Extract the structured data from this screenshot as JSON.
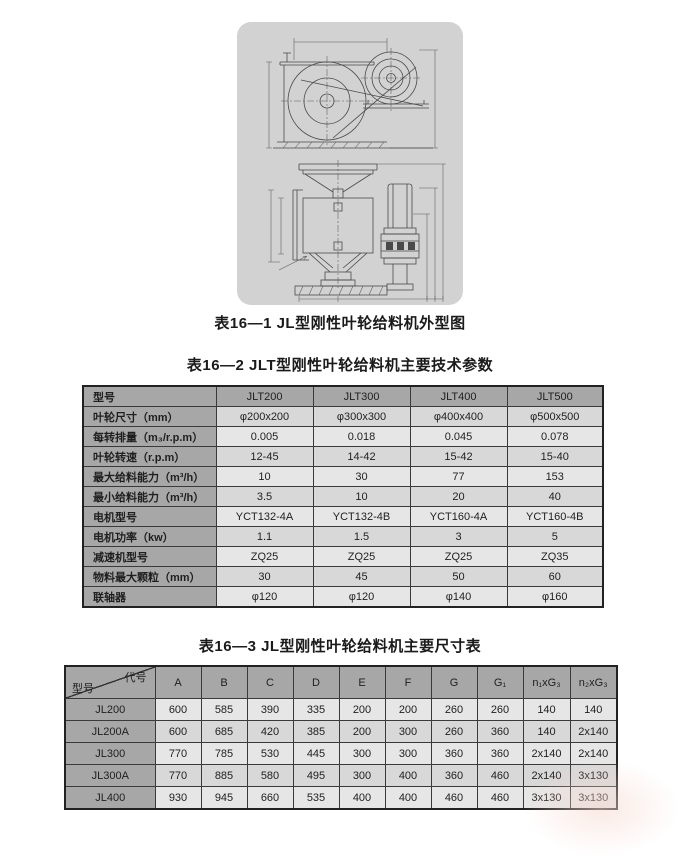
{
  "figure": {
    "caption": "表16—1 JL型刚性叶轮给料机外型图"
  },
  "table2": {
    "caption": "表16—2 JLT型刚性叶轮给料机主要技术参数",
    "rows": [
      {
        "label": "型号",
        "header": true,
        "values": [
          "JLT200",
          "JLT300",
          "JLT400",
          "JLT500"
        ]
      },
      {
        "label": "叶轮尺寸（mm）",
        "values": [
          "φ200x200",
          "φ300x300",
          "φ400x400",
          "φ500x500"
        ]
      },
      {
        "label": "每转排量（m₃/r.p.m）",
        "values": [
          "0.005",
          "0.018",
          "0.045",
          "0.078"
        ]
      },
      {
        "label": "叶轮转速（r.p.m）",
        "values": [
          "12-45",
          "14-42",
          "15-42",
          "15-40"
        ]
      },
      {
        "label": "最大给料能力（m³/h）",
        "values": [
          "10",
          "30",
          "77",
          "153"
        ]
      },
      {
        "label": "最小给料能力（m³/h）",
        "values": [
          "3.5",
          "10",
          "20",
          "40"
        ]
      },
      {
        "label": "电机型号",
        "values": [
          "YCT132-4A",
          "YCT132-4B",
          "YCT160-4A",
          "YCT160-4B"
        ]
      },
      {
        "label": "电机功率（kw）",
        "values": [
          "1.1",
          "1.5",
          "3",
          "5"
        ]
      },
      {
        "label": "减速机型号",
        "values": [
          "ZQ25",
          "ZQ25",
          "ZQ25",
          "ZQ35"
        ]
      },
      {
        "label": "物料最大颗粒（mm）",
        "values": [
          "30",
          "45",
          "50",
          "60"
        ]
      },
      {
        "label": "联轴器",
        "values": [
          "φ120",
          "φ120",
          "φ140",
          "φ160"
        ]
      }
    ]
  },
  "table3": {
    "caption": "表16—3 JL型刚性叶轮给料机主要尺寸表",
    "corner": {
      "top": "代号",
      "bottom": "型号"
    },
    "columns": [
      "A",
      "B",
      "C",
      "D",
      "E",
      "F",
      "G",
      "G₁",
      "n₁xG₃",
      "n₂xG₃"
    ],
    "rows": [
      {
        "model": "JL200",
        "values": [
          "600",
          "585",
          "390",
          "335",
          "200",
          "200",
          "260",
          "260",
          "140",
          "140"
        ]
      },
      {
        "model": "JL200A",
        "values": [
          "600",
          "685",
          "420",
          "385",
          "200",
          "300",
          "260",
          "360",
          "140",
          "2x140"
        ]
      },
      {
        "model": "JL300",
        "values": [
          "770",
          "785",
          "530",
          "445",
          "300",
          "300",
          "360",
          "360",
          "2x140",
          "2x140"
        ]
      },
      {
        "model": "JL300A",
        "values": [
          "770",
          "885",
          "580",
          "495",
          "300",
          "400",
          "360",
          "460",
          "2x140",
          "3x130"
        ]
      },
      {
        "model": "JL400",
        "values": [
          "930",
          "945",
          "660",
          "535",
          "400",
          "400",
          "460",
          "460",
          "3x130",
          "3x130"
        ]
      }
    ]
  },
  "colors": {
    "panel_bg": "#d2d2d2",
    "header_cell_bg": "#a7a7a7",
    "row_shade_dark": "#d8d8d8",
    "row_shade_light": "#e6e6e6",
    "table_border": "#3a3a3a",
    "text": "#1f1f1f"
  }
}
